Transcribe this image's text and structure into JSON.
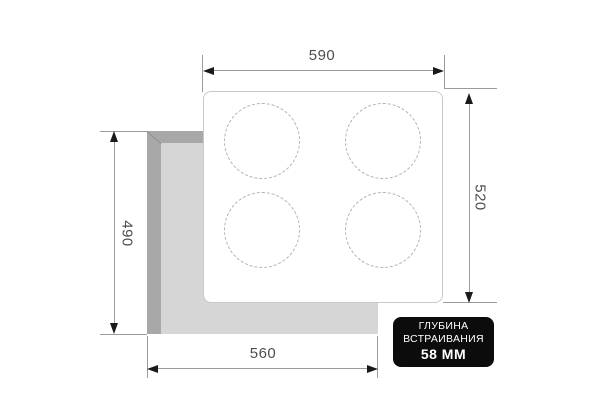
{
  "diagram": {
    "type": "built-in-hob-installation-dimensions",
    "burner_count": 4,
    "dimensions": {
      "panel_width": "590",
      "panel_depth": "520",
      "cutout_depth": "490",
      "cutout_width": "560"
    },
    "badge": {
      "line1": "ГЛУБИНА",
      "line2": "ВСТРАИВАНИЯ",
      "line3": "58 ММ"
    },
    "colors": {
      "background": "#ffffff",
      "cutout_edge": "#a8a8a8",
      "cutout_face": "#d6d6d6",
      "panel_fill": "#ffffff",
      "panel_border": "#c8c8c8",
      "burner_dash": "#b3b3b3",
      "dimension_line": "#9b9b9b",
      "arrow": "#1a1a1a",
      "label_text": "#4d4d4d",
      "badge_bg": "#0c0c0c",
      "badge_text": "#ffffff"
    }
  }
}
